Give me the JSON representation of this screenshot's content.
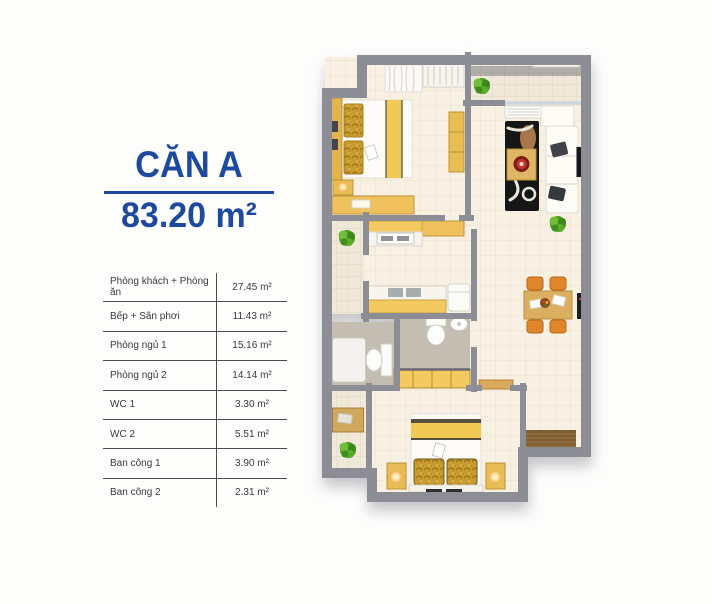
{
  "panel": {
    "unit_name": "CĂN A",
    "unit_area": "83.20 m²",
    "rows": [
      {
        "label": "Phòng khách + Phòng ăn",
        "area": "27.45 m²"
      },
      {
        "label": "Bếp + Sân phơi",
        "area": "11.43 m²"
      },
      {
        "label": "Phòng ngủ 1",
        "area": "15.16 m²"
      },
      {
        "label": "Phòng ngủ 2",
        "area": "14.14 m²"
      },
      {
        "label": "WC 1",
        "area": "3.30 m²"
      },
      {
        "label": "WC 2",
        "area": "5.51 m²"
      },
      {
        "label": "Ban công 1",
        "area": "3.90 m²"
      },
      {
        "label": "Ban công 2",
        "area": "2.31 m²"
      }
    ]
  },
  "floorplan": {
    "type": "3d-top-down-apartment-render",
    "furniture_visible": [
      "double-bed-1",
      "wardrobe",
      "curtain",
      "desk",
      "tall-cabinet",
      "nightstand-lamp",
      "sofa",
      "rug",
      "coffee-table",
      "tv",
      "kitchen-counters",
      "fridge",
      "toilet-wc1",
      "shower-tray",
      "toilet-wc2",
      "sink-wc2",
      "closet",
      "double-bed-2",
      "two-nightstand-lamps",
      "dining-table",
      "four-chairs",
      "entry-door-mat",
      "plants"
    ],
    "palette": {
      "accent_blue": "#1d4a9e",
      "wall_gray": "#8d8d96",
      "floor_cream": "#f8f1e3",
      "wc_tile_gray": "#c3bdb2",
      "wood_yellow": "#f2ca5e",
      "gold_fabric": "#c89b2e",
      "chair_orange": "#e0862a",
      "table_line": "#4c4c4c",
      "text_gray": "#3a3a3a"
    }
  }
}
